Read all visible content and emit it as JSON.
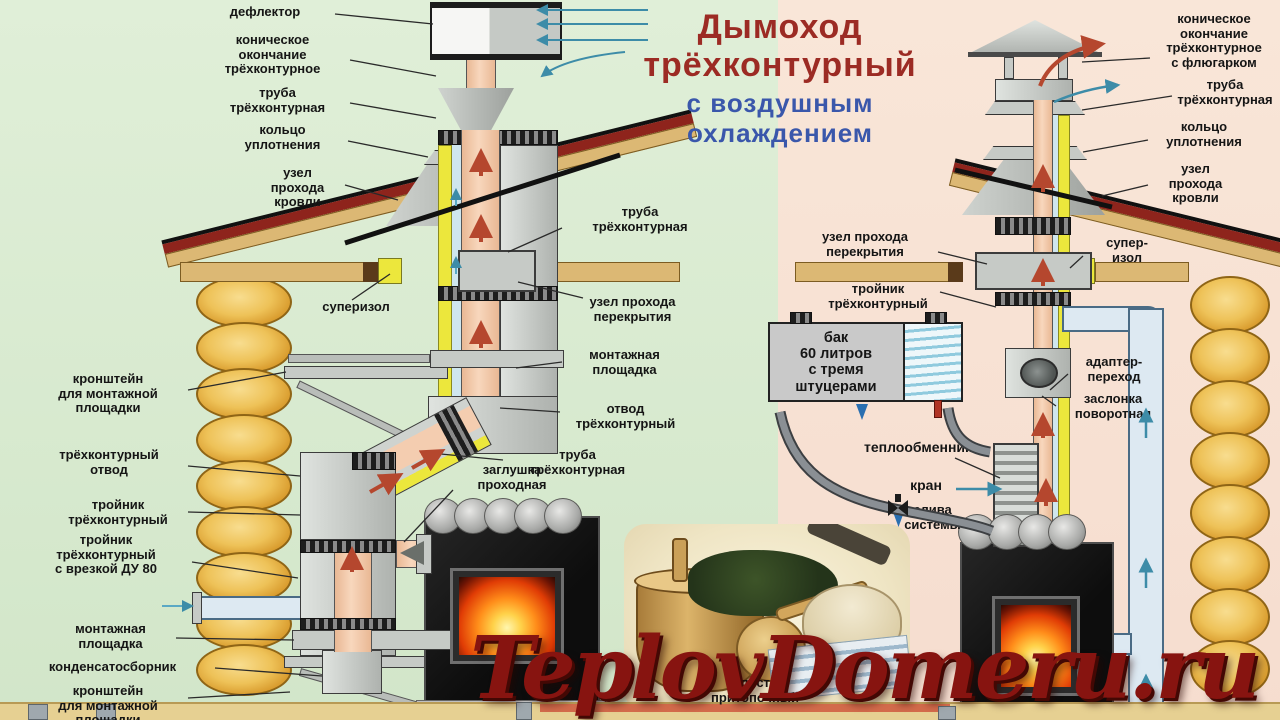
{
  "title": {
    "line1": "Дымоход",
    "line2": "трёхконтурный",
    "line3": "с воздушным",
    "line4": "охлаждением"
  },
  "watermark": "TeplovDomeru.ru",
  "colors": {
    "title_red": "#9c2b24",
    "title_blue": "#3a57ab",
    "watermark_red": "#871410",
    "bg_left_green": "#d8e9cf",
    "bg_right_pink": "#f8e2d4",
    "roof_red": "#8e241c",
    "log_yellow": "#eec258",
    "pipe_core_pink": "#f3cbae",
    "insulation_yellow": "#ece73c"
  },
  "labels": {
    "deflector": "дефлектор",
    "conic_end_left": "коническое\nокончание\nтрёхконтурное",
    "pipe_left_top": "труба\nтрёхконтурная",
    "ring_left": "кольцо\nуплотнения",
    "roof_pass_left": "узел\nпрохода\nкровли",
    "pipe_left_mid": "труба\nтрёхконтурная",
    "floor_pass_left": "узел прохода\nперекрытия",
    "superizol_left": "суперизол",
    "mount_pad_mid": "монтажная\nплощадка",
    "elbow_mid": "отвод\nтрёхконтурный",
    "pipe_left_low": "труба\nтрёхконтурная",
    "plug": "заглушка\nпроходная",
    "bracket_top": "кронштейн\nдля монтажной\nплощадки",
    "elbow_left": "трёхконтурный\nотвод",
    "tee_left": "тройник\nтрёхконтурный",
    "tee_du80": "тройник\nтрёхконтурный\nс врезкой ДУ 80",
    "mount_pad_bottom": "монтажная\nплощадка",
    "condensate": "конденсатосборник",
    "bracket_bottom": "кронштейн\nдля монтажной\nплощадки",
    "conic_end_right": "коническое\nокончание\nтрёхконтурное\nс флюгарком",
    "pipe_right_top": "труба\nтрёхконтурная",
    "ring_right": "кольцо\nуплотнения",
    "roof_pass_right": "узел\nпрохода\nкровли",
    "floor_pass_right": "узел прохода\nперекрытия",
    "tee_right": "тройник\nтрёхконтурный",
    "superizol_right": "супер-\nизол",
    "tank": "бак\n60 литров\nс тремя\nштуцерами",
    "adapter": "адаптер-\nпереход",
    "damper": "заслонка\nповоротная",
    "heat_exchanger": "теплообменник",
    "tap": "кран",
    "drain": "слива\nсистемы",
    "floor_sheet": "лист\nпритопочный"
  }
}
